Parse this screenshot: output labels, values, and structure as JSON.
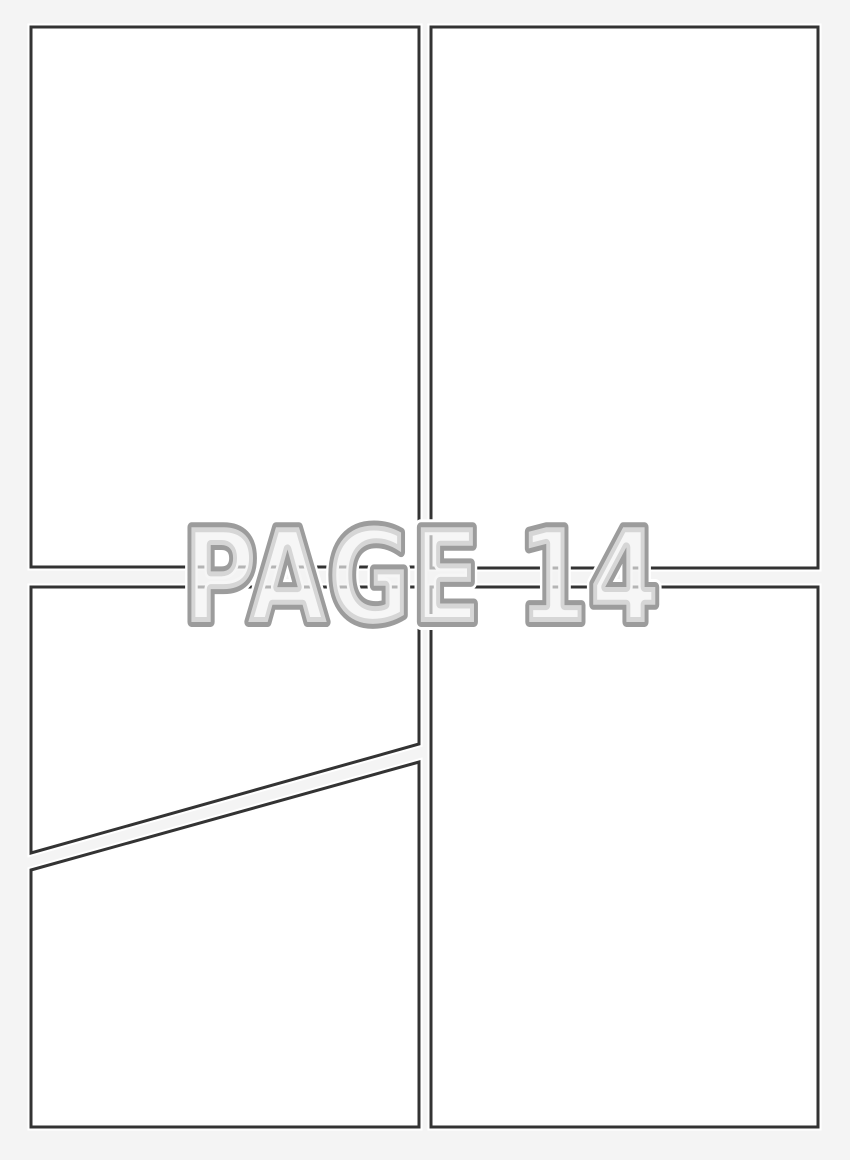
{
  "page": {
    "watermark_label": "PAGE 14",
    "colors": {
      "background": "#f4f4f4",
      "panel_fill": "#ffffff",
      "panel_border": "#333333",
      "watermark_fill": "#f1f1f1",
      "watermark_outline": "#9c9c9c",
      "watermark_halo": "#ffffff"
    }
  }
}
